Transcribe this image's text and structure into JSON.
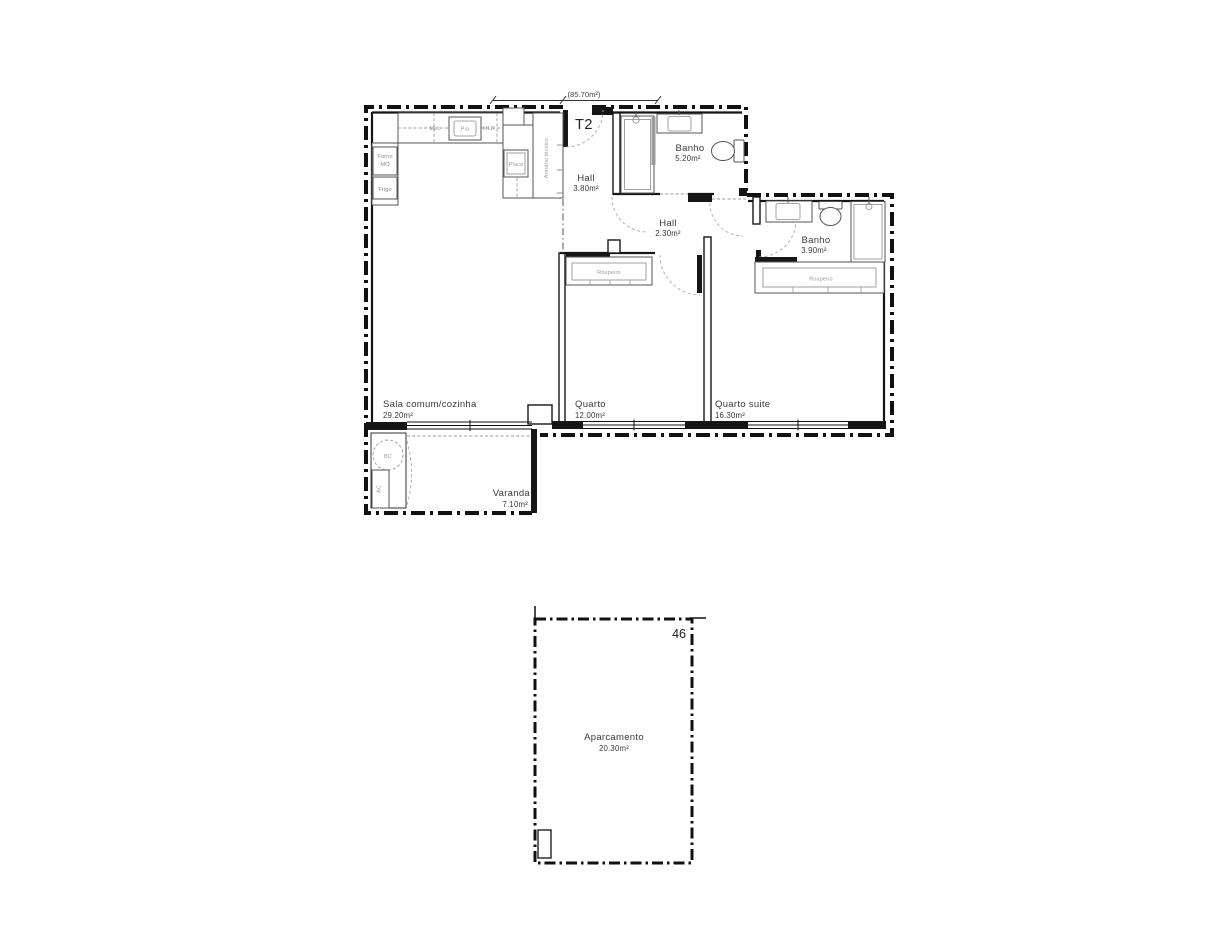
{
  "ink": "#161616",
  "plan": {
    "dimension_label": "(85.70m²)",
    "type_label": "T2",
    "rooms": {
      "sala": {
        "name": "Sala comum/cozinha",
        "area": "29.20m²"
      },
      "hall1": {
        "name": "Hall",
        "area": "3.80m²"
      },
      "hall2": {
        "name": "Hall",
        "area": "2.30m²"
      },
      "banho1": {
        "name": "Banho",
        "area": "5.20m²"
      },
      "banho2": {
        "name": "Banho",
        "area": "3.90m²"
      },
      "quarto": {
        "name": "Quarto",
        "area": "12.00m²"
      },
      "suite": {
        "name": "Quarto suite",
        "area": "16.30m²"
      },
      "varanda": {
        "name": "Varanda",
        "area": "7.10m²"
      }
    },
    "fixtures": {
      "forno_line1": "Forno",
      "forno_line2": "MO",
      "frigo": "Frigo",
      "mll": "MLL",
      "pia": "Pia",
      "mlr": "MLR",
      "placa": "Placa",
      "armario": "Armário técnico",
      "roupeiro": "Roupeiro",
      "bc": "BC",
      "ac": "AC"
    }
  },
  "parking": {
    "name": "Aparcamento",
    "area": "20.30m²",
    "number": "46"
  }
}
